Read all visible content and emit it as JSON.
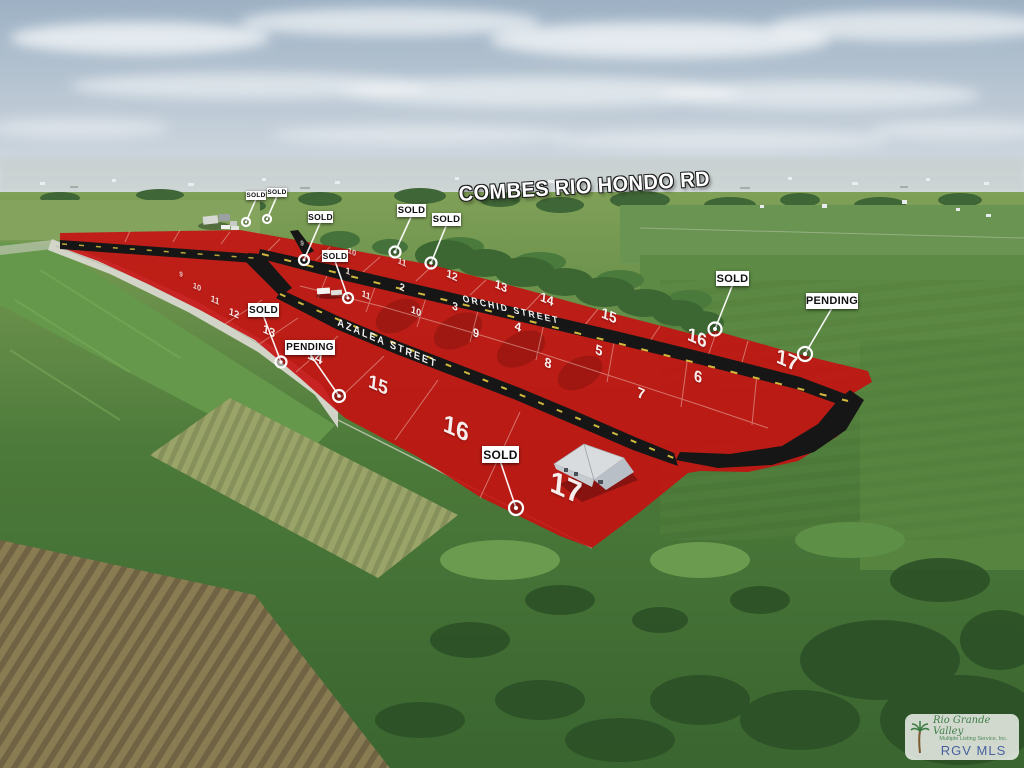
{
  "labels": {
    "main_road": "COMBES RIO HONDO RD",
    "street_1": "ORCHID STREET",
    "street_2": "AZALEA STREET"
  },
  "signs": [
    {
      "label": "SOLD",
      "box": [
        246,
        191,
        20,
        9
      ],
      "fs": 6.5,
      "pin": [
        246,
        222
      ],
      "pr": 4
    },
    {
      "label": "SOLD",
      "box": [
        267,
        188,
        20,
        9
      ],
      "fs": 6.5,
      "pin": [
        267,
        219
      ],
      "pr": 4
    },
    {
      "label": "SOLD",
      "box": [
        308,
        211,
        25,
        12
      ],
      "fs": 8.5,
      "pin": [
        304,
        260
      ],
      "pr": 5
    },
    {
      "label": "SOLD",
      "box": [
        322,
        250,
        26,
        12
      ],
      "fs": 8.5,
      "pin": [
        348,
        298
      ],
      "pr": 5
    },
    {
      "label": "SOLD",
      "box": [
        397,
        204,
        29,
        13
      ],
      "fs": 9.5,
      "pin": [
        395,
        252
      ],
      "pr": 5.5
    },
    {
      "label": "SOLD",
      "box": [
        432,
        213,
        29,
        13
      ],
      "fs": 9.5,
      "pin": [
        431,
        263
      ],
      "pr": 5.5
    },
    {
      "label": "SOLD",
      "box": [
        716,
        271,
        33,
        15
      ],
      "fs": 11,
      "pin": [
        715,
        329
      ],
      "pr": 6.5
    },
    {
      "label": "PENDING",
      "box": [
        806,
        293,
        52,
        16
      ],
      "fs": 11,
      "pin": [
        805,
        354
      ],
      "pr": 7
    },
    {
      "label": "SOLD",
      "box": [
        248,
        303,
        31,
        14
      ],
      "fs": 10,
      "pin": [
        281,
        362
      ],
      "pr": 5.5
    },
    {
      "label": "PENDING",
      "box": [
        285,
        340,
        50,
        15
      ],
      "fs": 10,
      "pin": [
        339,
        396
      ],
      "pr": 6
    },
    {
      "label": "SOLD",
      "box": [
        482,
        446,
        37,
        17
      ],
      "fs": 12,
      "pin": [
        516,
        508
      ],
      "pr": 7
    }
  ],
  "lots": [
    {
      "g": "north",
      "n": "9",
      "x": 302,
      "y": 244,
      "fs": 7,
      "o": 0.7
    },
    {
      "g": "north",
      "n": "10",
      "x": 352,
      "y": 252,
      "fs": 8,
      "o": 0.7
    },
    {
      "g": "north",
      "n": "11",
      "x": 402,
      "y": 262,
      "fs": 9,
      "o": 0.8
    },
    {
      "g": "north",
      "n": "12",
      "x": 452,
      "y": 276,
      "fs": 11,
      "o": 0.9
    },
    {
      "g": "north",
      "n": "13",
      "x": 501,
      "y": 286,
      "fs": 12,
      "o": 0.92
    },
    {
      "g": "north",
      "n": "14",
      "x": 547,
      "y": 299,
      "fs": 13,
      "o": 0.92
    },
    {
      "g": "north",
      "n": "15",
      "x": 609,
      "y": 316,
      "fs": 15,
      "o": 0.92
    },
    {
      "g": "north",
      "n": "16",
      "x": 697,
      "y": 339,
      "fs": 19,
      "o": 0.92
    },
    {
      "g": "north",
      "n": "17",
      "x": 787,
      "y": 361,
      "fs": 21,
      "o": 0.92
    },
    {
      "g": "mid-upper",
      "n": "1",
      "x": 348,
      "y": 271,
      "fs": 9,
      "o": 0.9
    },
    {
      "g": "mid-upper",
      "n": "2",
      "x": 402,
      "y": 288,
      "fs": 10,
      "o": 0.9
    },
    {
      "g": "mid-upper",
      "n": "3",
      "x": 455,
      "y": 307,
      "fs": 11,
      "o": 0.92
    },
    {
      "g": "mid-upper",
      "n": "4",
      "x": 518,
      "y": 327,
      "fs": 12.5,
      "o": 0.92
    },
    {
      "g": "mid-upper",
      "n": "5",
      "x": 599,
      "y": 350,
      "fs": 14,
      "o": 0.92
    },
    {
      "g": "mid-upper",
      "n": "6",
      "x": 698,
      "y": 378,
      "fs": 16,
      "o": 0.92
    },
    {
      "g": "mid-lower",
      "n": "11",
      "x": 366,
      "y": 295,
      "fs": 9,
      "o": 0.9
    },
    {
      "g": "mid-lower",
      "n": "10",
      "x": 416,
      "y": 312,
      "fs": 10,
      "o": 0.9
    },
    {
      "g": "mid-lower",
      "n": "9",
      "x": 476,
      "y": 333,
      "fs": 12,
      "o": 0.92
    },
    {
      "g": "mid-lower",
      "n": "8",
      "x": 548,
      "y": 363,
      "fs": 13.5,
      "o": 0.92
    },
    {
      "g": "mid-lower",
      "n": "7",
      "x": 641,
      "y": 394,
      "fs": 15,
      "o": 0.92
    },
    {
      "g": "south",
      "n": "9",
      "x": 181,
      "y": 275,
      "fs": 7,
      "o": 0.75
    },
    {
      "g": "south",
      "n": "10",
      "x": 197,
      "y": 287,
      "fs": 8,
      "o": 0.8
    },
    {
      "g": "south",
      "n": "11",
      "x": 215,
      "y": 300,
      "fs": 9,
      "o": 0.85
    },
    {
      "g": "south",
      "n": "12",
      "x": 234,
      "y": 314,
      "fs": 10,
      "o": 0.9
    },
    {
      "g": "south",
      "n": "13",
      "x": 269,
      "y": 331,
      "fs": 12,
      "o": 0.92
    },
    {
      "g": "south",
      "n": "14",
      "x": 315,
      "y": 357,
      "fs": 15,
      "o": 0.92
    },
    {
      "g": "south",
      "n": "15",
      "x": 378,
      "y": 386,
      "fs": 19,
      "o": 0.92
    },
    {
      "g": "south",
      "n": "16",
      "x": 456,
      "y": 429,
      "fs": 25,
      "o": 0.92
    },
    {
      "g": "south",
      "n": "17",
      "x": 566,
      "y": 488,
      "fs": 31,
      "o": 0.92
    }
  ],
  "watermark": {
    "brand": "Rio Grande Valley",
    "subtitle": "Multiple Listing Service, Inc.",
    "mls": "RGV MLS"
  },
  "colors": {
    "red_overlay": "#c51111",
    "road_black": "#161616",
    "dash_yellow": "#e6cb42",
    "sign_bg": "#ffffff",
    "sign_text": "#101010",
    "pin_white": "#ffffff",
    "mls_blue": "#47619e",
    "mls_green": "#3f7d46"
  }
}
